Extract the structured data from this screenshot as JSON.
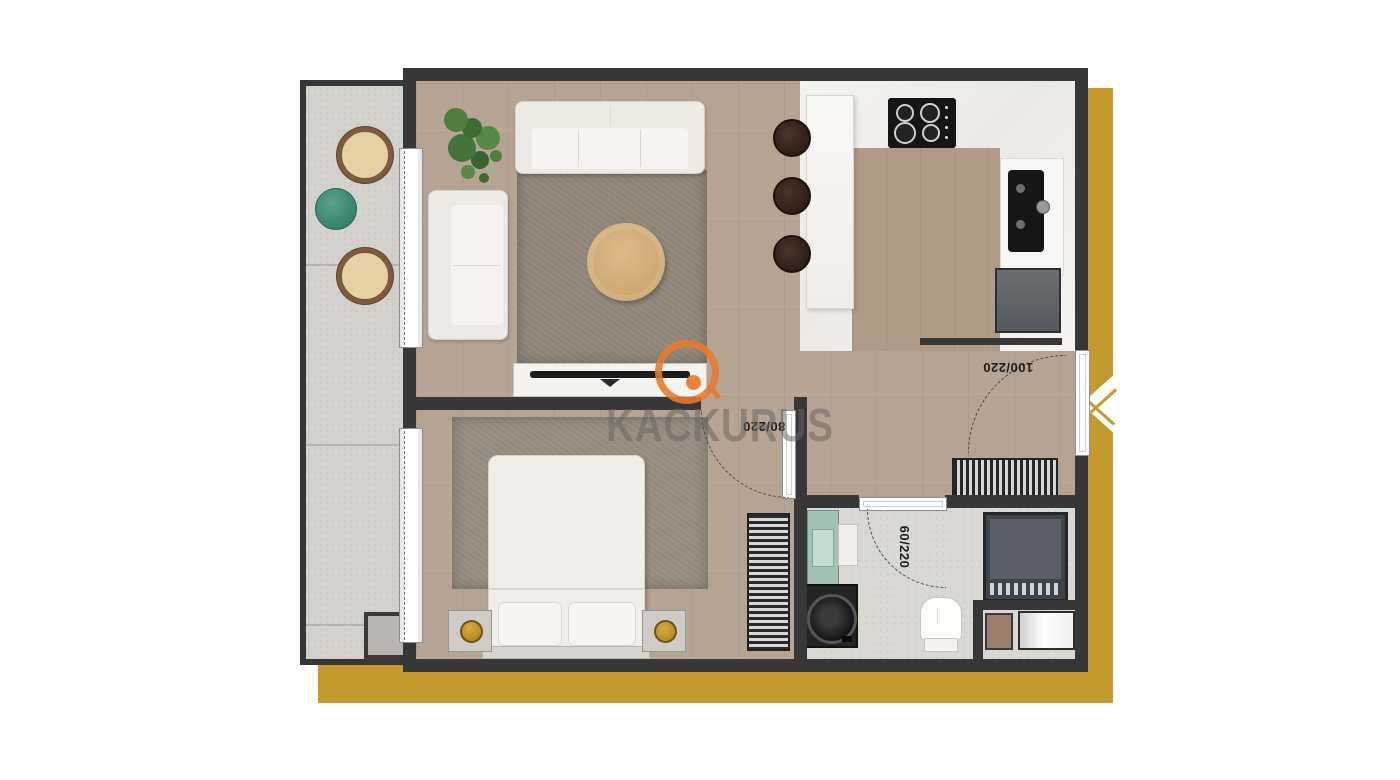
{
  "watermark": {
    "brand": "KACKURUS"
  },
  "doors": {
    "entry": "100/220",
    "bedroom": "80/220",
    "bathroom": "60/220"
  },
  "palette": {
    "gold": "#c49a2f",
    "wall": "#373737",
    "wood": "#b5a393",
    "marble": "#f1efec",
    "balcony": "#d3d1cc",
    "bath": "#dad8d3",
    "rug": "#8e8578",
    "logo": "#e87a2b",
    "teal": "#48917f",
    "plant": "#4e7d3c"
  },
  "rooms": {
    "living": [
      "sofa",
      "loveseat",
      "rug",
      "coffee-table-large",
      "coffee-table-small",
      "tv-unit",
      "plant"
    ],
    "kitchen": [
      "bar-counter",
      "cooktop",
      "sink",
      "fridge",
      "bar-stool",
      "bar-stool",
      "bar-stool"
    ],
    "hall": [
      "shoe-cabinet",
      "doormat",
      "cabinet"
    ],
    "bedroom": [
      "bed",
      "pillow",
      "pillow",
      "nightstand",
      "nightstand",
      "lamp",
      "lamp",
      "rug",
      "wardrobe"
    ],
    "bathroom": [
      "vanity",
      "washing-machine",
      "toilet",
      "shower"
    ],
    "balcony": [
      "chair",
      "chair",
      "side-table",
      "column"
    ]
  }
}
